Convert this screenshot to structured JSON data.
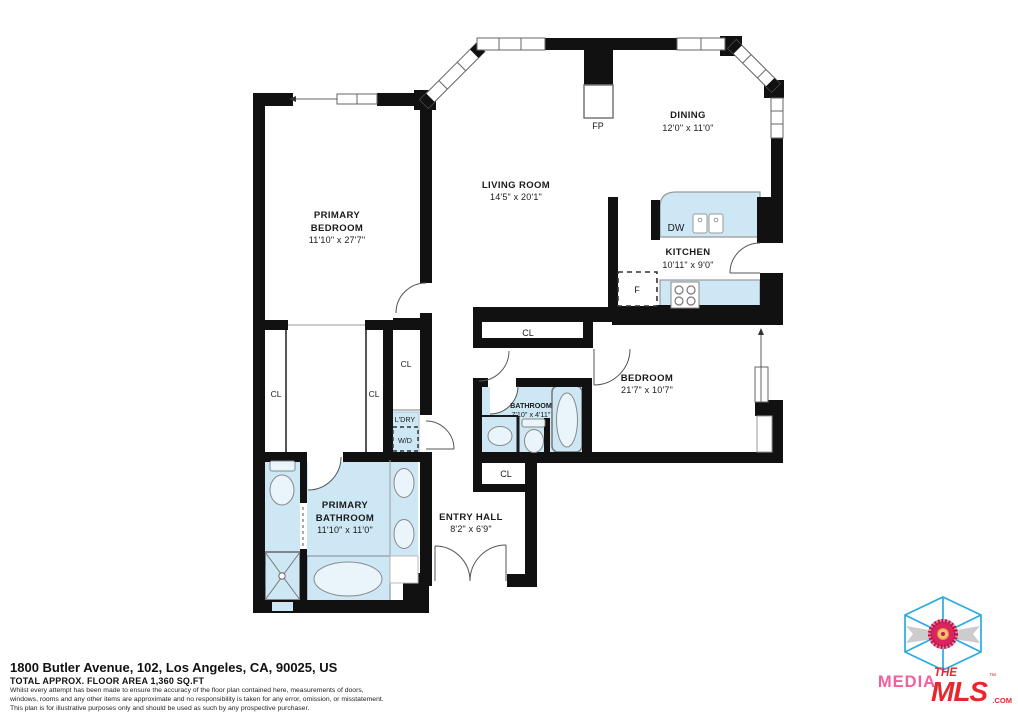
{
  "rooms": {
    "primary_bedroom": {
      "line1": "PRIMARY",
      "line2": "BEDROOM",
      "dims": "11'10\" x 27'7\""
    },
    "living_room": {
      "label": "LIVING ROOM",
      "dims": "14'5\" x 20'1\""
    },
    "dining": {
      "label": "DINING",
      "dims": "12'0\" x 11'0\""
    },
    "kitchen": {
      "label": "KITCHEN",
      "dims": "10'11\" x 9'0\""
    },
    "bedroom": {
      "label": "BEDROOM",
      "dims": "21'7\" x 10'7\""
    },
    "bathroom": {
      "label": "BATHROOM",
      "dims": "7'10\" x 4'11\""
    },
    "primary_bathroom": {
      "line1": "PRIMARY",
      "line2": "BATHROOM",
      "dims": "11'10\" x 11'0\""
    },
    "entry_hall": {
      "label": "ENTRY HALL",
      "dims": "8'2\" x 6'9\""
    }
  },
  "labels": {
    "closet": "CL",
    "fireplace": "FP",
    "dishwasher": "DW",
    "fridge": "F",
    "laundry": "L'DRY",
    "washer_dryer": "W/D"
  },
  "footer": {
    "address": "1800 Butler Avenue, 102, Los Angeles, CA, 90025, US",
    "area": "TOTAL APPROX. FLOOR AREA 1,360 SQ.FT",
    "disclaimer": [
      "Whilst every attempt has been made to ensure the accuracy of the floor plan contained here, measurements of doors,",
      "windows, rooms and any other items are approximate and no responsibility is taken for any error, omission, or misstatement.",
      "This plan is for illustrative purposes only and should be used as such by any prospective purchaser."
    ]
  },
  "logo": {
    "media": "MEDIA",
    "the": "THE",
    "mls": "MLS",
    "com": ".COM",
    "tm": "™"
  },
  "colors": {
    "wall": "#111111",
    "fixture_fill": "#cde7f5",
    "fixture_stroke": "#8d9aa5",
    "logo_cyan": "#29abe2",
    "logo_pink": "#f0609e",
    "logo_red": "#e8262d"
  }
}
